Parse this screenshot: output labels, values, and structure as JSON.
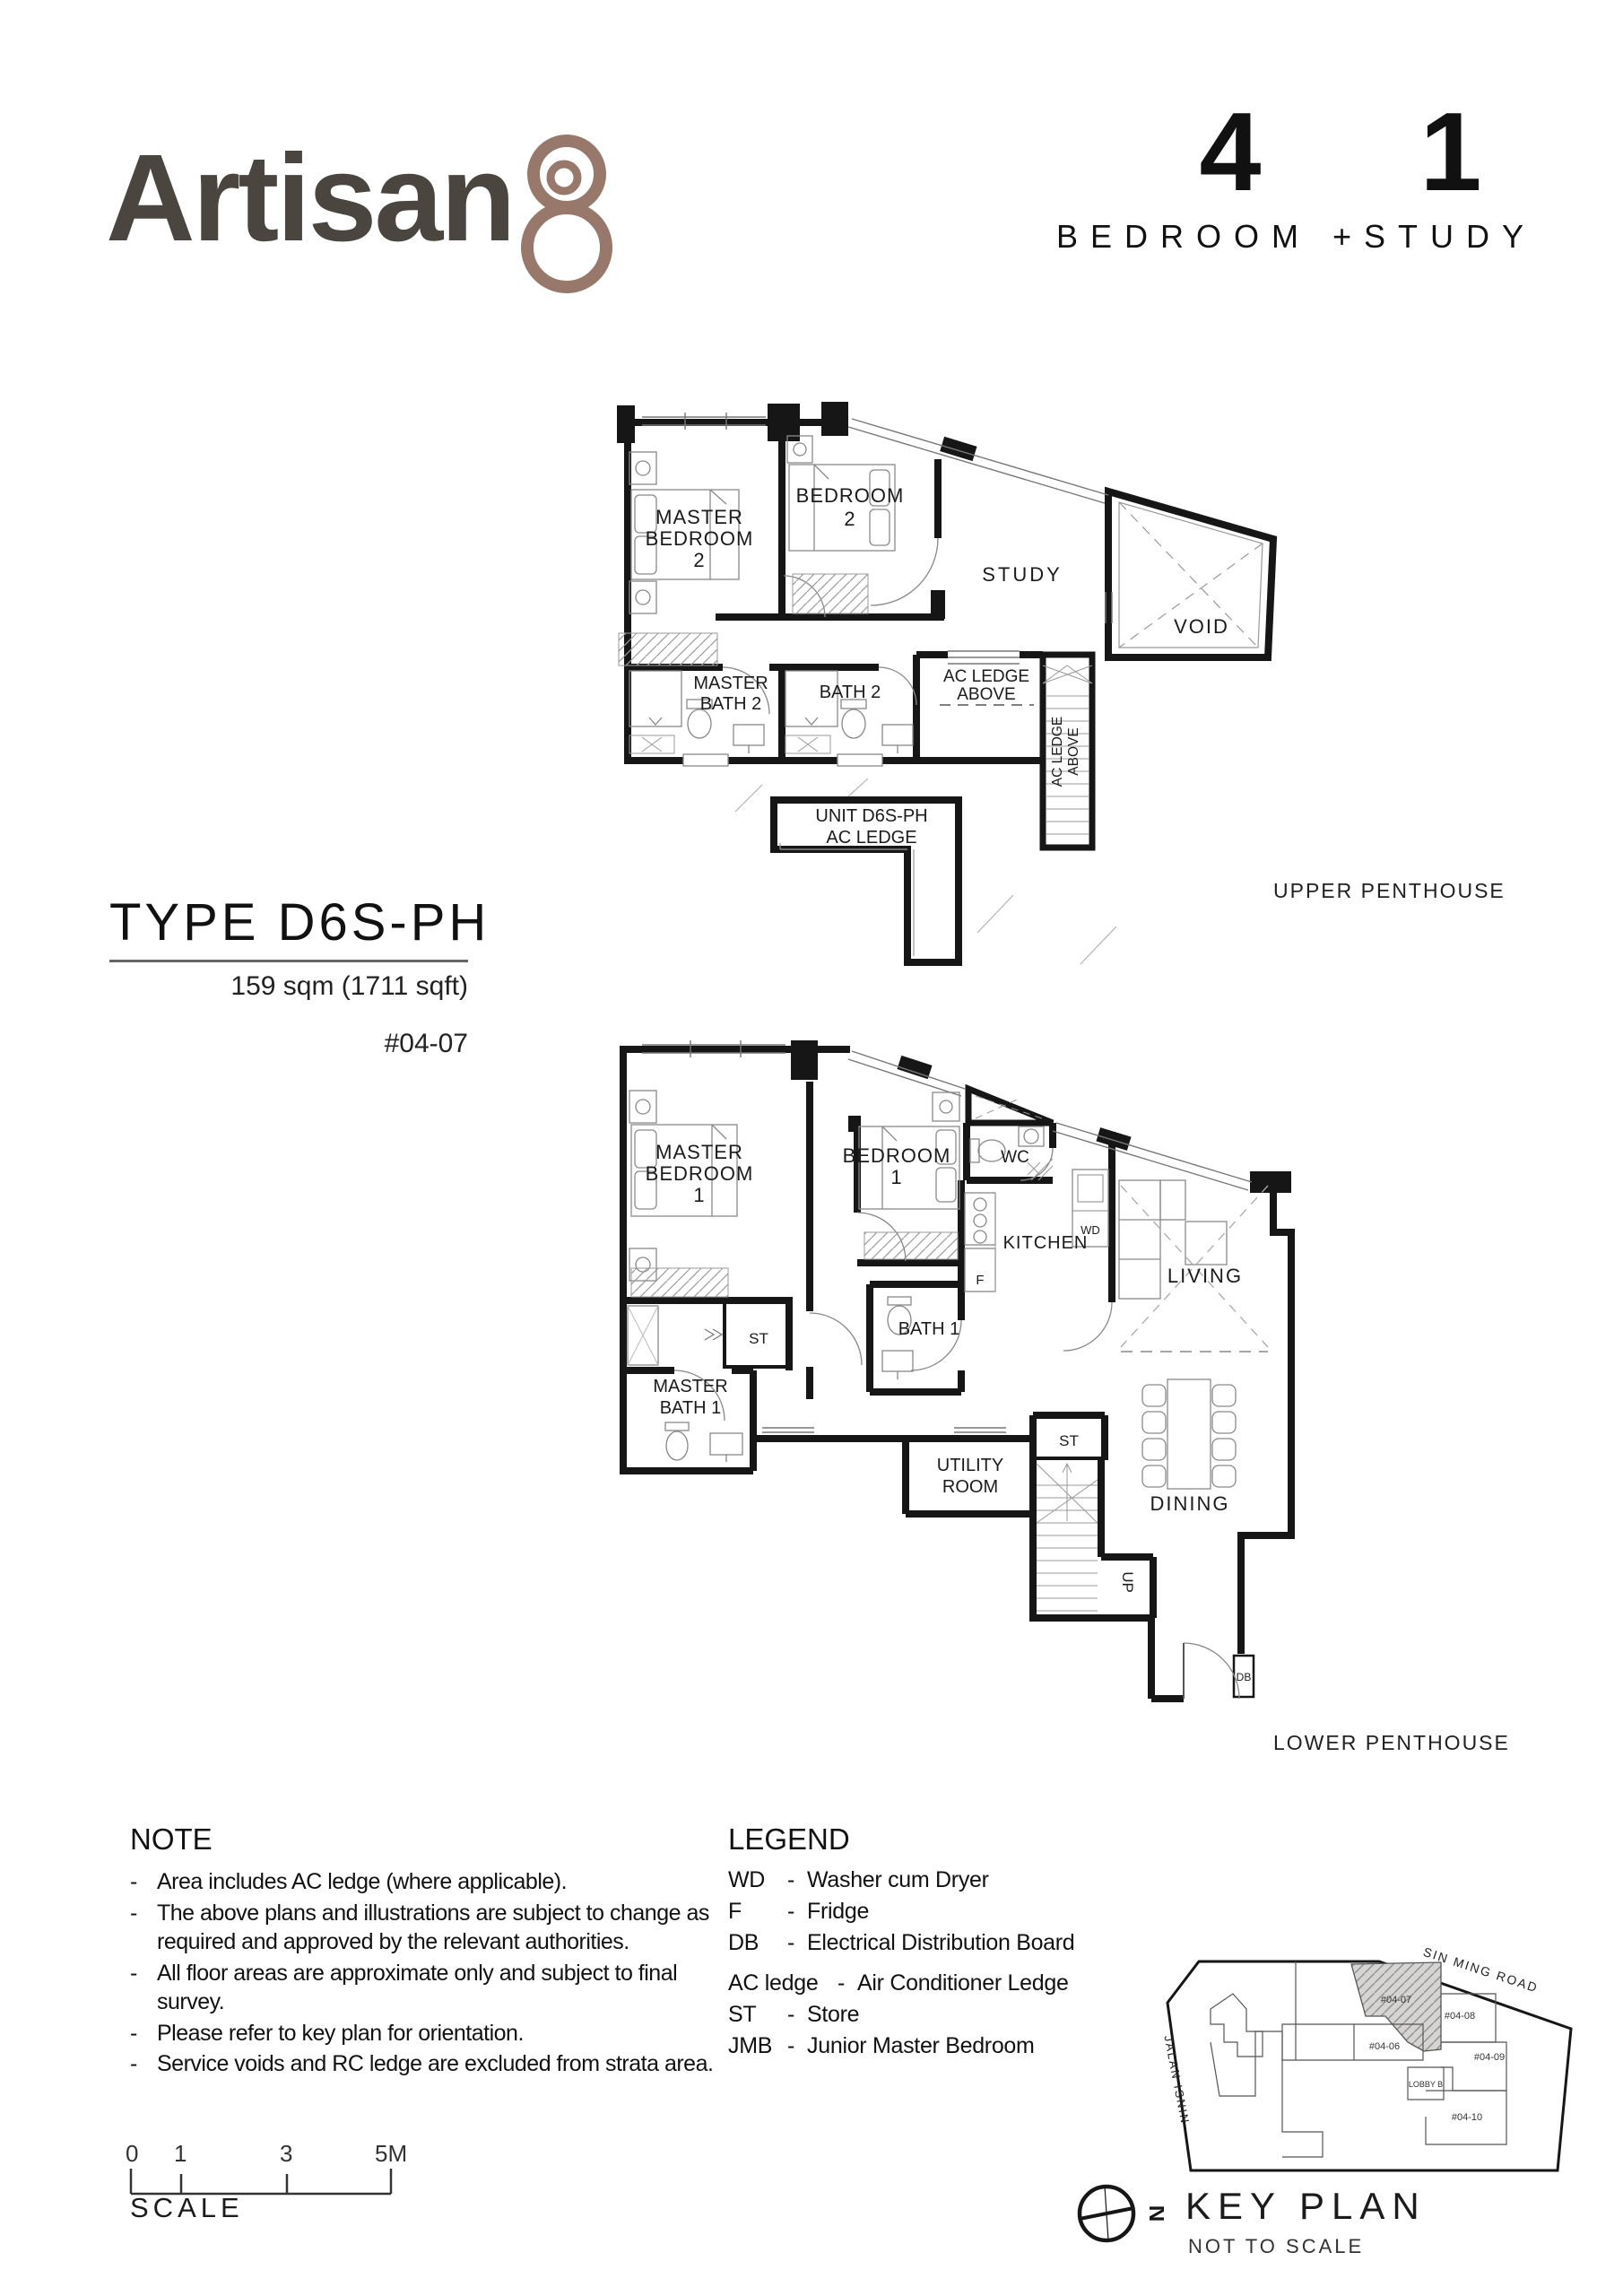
{
  "header": {
    "logo_text": "Artisan",
    "logo_numeral": "8",
    "bed_count": "4",
    "study_count": "1",
    "unit_mix_label": "BEDROOM +STUDY"
  },
  "type_block": {
    "title": "TYPE D6S-PH",
    "area": "159 sqm (1711 sqft)",
    "unit_number": "#04-07"
  },
  "upper_plan": {
    "caption": "UPPER PENTHOUSE",
    "labels": {
      "master_bedroom_2": [
        "MASTER",
        "BEDROOM",
        "2"
      ],
      "bedroom_2": [
        "BEDROOM",
        "2"
      ],
      "study": "STUDY",
      "void": "VOID",
      "master_bath_2": [
        "MASTER",
        "BATH 2"
      ],
      "bath_2": "BATH 2",
      "ac_ledge_above_h": [
        "AC LEDGE",
        "ABOVE"
      ],
      "ac_ledge_above_v": [
        "AC LEDGE",
        "ABOVE"
      ],
      "unit_ac_ledge": [
        "UNIT D6S-PH",
        "AC LEDGE"
      ]
    }
  },
  "lower_plan": {
    "caption": "LOWER PENTHOUSE",
    "labels": {
      "master_bedroom_1": [
        "MASTER",
        "BEDROOM",
        "1"
      ],
      "bedroom_1": [
        "BEDROOM",
        "1"
      ],
      "wc": "WC",
      "kitchen": "KITCHEN",
      "living": "LIVING",
      "dining": "DINING",
      "bath_1": "BATH 1",
      "master_bath_1": [
        "MASTER",
        "BATH 1"
      ],
      "utility": [
        "UTILITY",
        "ROOM"
      ],
      "store_1": "ST",
      "store_2": "ST",
      "up": "UP",
      "db": "DB",
      "fridge": "F",
      "wd": "WD"
    }
  },
  "note": {
    "title": "NOTE",
    "items": [
      "Area includes AC ledge (where applicable).",
      "The above plans and illustrations are subject to change as required and approved by the relevant authorities.",
      "All floor areas are approximate only and subject to final survey.",
      "Please refer to key plan for orientation.",
      "Service voids and RC ledge are excluded from strata area."
    ]
  },
  "legend": {
    "title": "LEGEND",
    "entries": [
      {
        "abbr": "WD",
        "desc": "Washer cum Dryer"
      },
      {
        "abbr": "F",
        "desc": "Fridge"
      },
      {
        "abbr": "DB",
        "desc": "Electrical Distribution Board"
      },
      {
        "abbr": "AC ledge",
        "desc": "Air Conditioner Ledge"
      },
      {
        "abbr": "ST",
        "desc": "Store"
      },
      {
        "abbr": "JMB",
        "desc": "Junior Master Bedroom"
      }
    ]
  },
  "scale_bar": {
    "ticks": [
      "0",
      "1",
      "3",
      "5M"
    ],
    "label": "SCALE"
  },
  "key_plan": {
    "title": "KEY PLAN",
    "subtitle": "NOT TO SCALE",
    "north": "N",
    "road_1": "SIN MING ROAD",
    "road_2": "JALAN ISNIN",
    "units": [
      "#04-07",
      "#04-08",
      "#04-06",
      "#04-09",
      "#04-10"
    ],
    "lobby": "LOBBY B",
    "highlighted_unit": "#04-07"
  },
  "colors": {
    "logo_text": "#4b4540",
    "logo_numeral": "#97786a",
    "line": "#161616",
    "highlight_fill": "#d6d4d2"
  }
}
